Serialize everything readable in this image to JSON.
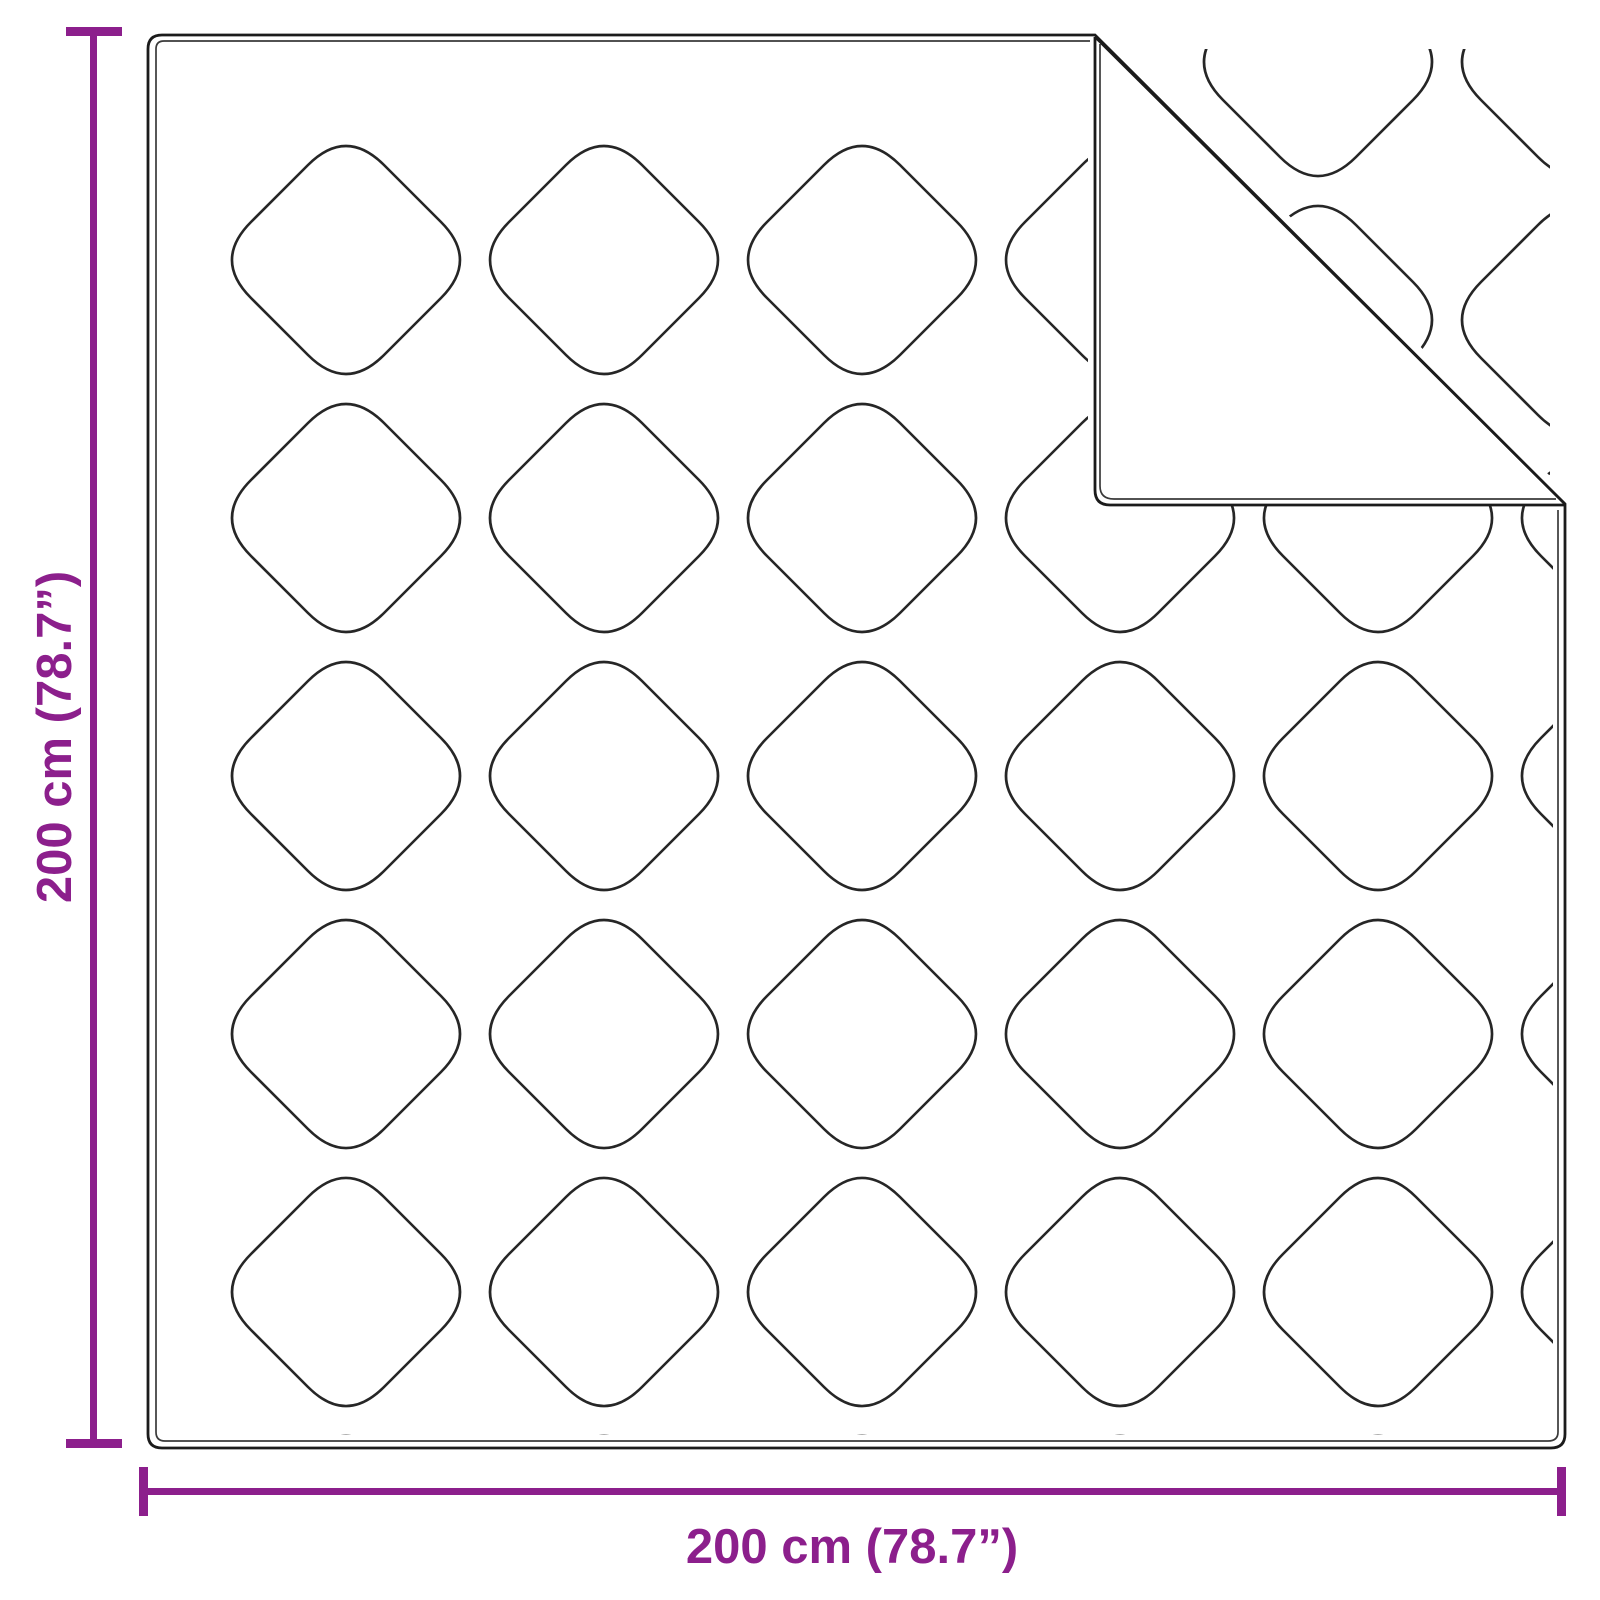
{
  "diagram": {
    "vertical_dimension_label": "200 cm (78.7”)",
    "horizontal_dimension_label": "200 cm (78.7”)"
  },
  "colors": {
    "accent": "#8C1F8C",
    "outline": "#1B1B1B",
    "outline_inner": "#3A3A3A",
    "stitch": "#262626",
    "background": "#FFFFFF"
  }
}
